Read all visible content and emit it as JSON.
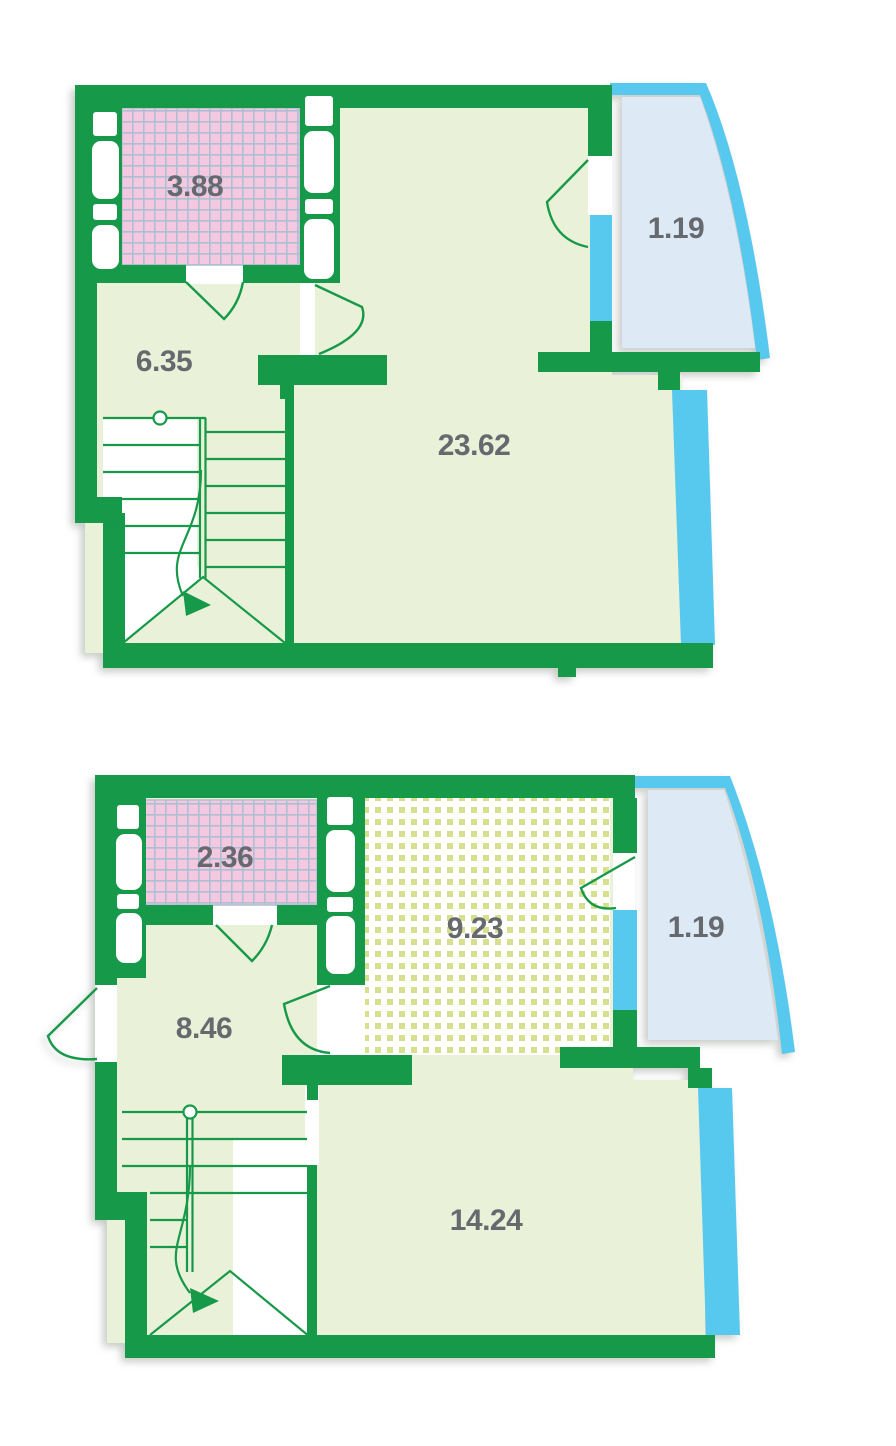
{
  "document": {
    "type": "apartment-floor-plan",
    "levels": 2
  },
  "colors": {
    "wall_green": "#17994a",
    "floor_light_green": "#e9f1d9",
    "bathroom_tile_pink": "#f4c8e1",
    "tile_grid_line": "#aebfd2",
    "kitchen_dot_yellow_green": "#d6e08d",
    "kitchen_background": "#ffffff",
    "balcony_fill_light_blue": "#dde9f5",
    "glazing_cyan": "#57c8ee",
    "label_grey": "#66696e"
  },
  "plans": [
    {
      "name": "upper-level",
      "rooms": [
        {
          "id": "bathroom",
          "area": "3.88"
        },
        {
          "id": "hallway",
          "area": "6.35"
        },
        {
          "id": "living-room",
          "area": "23.62"
        },
        {
          "id": "balcony",
          "area": "1.19"
        }
      ]
    },
    {
      "name": "lower-level",
      "rooms": [
        {
          "id": "bathroom",
          "area": "2.36"
        },
        {
          "id": "hallway",
          "area": "8.46"
        },
        {
          "id": "kitchen",
          "area": "9.23"
        },
        {
          "id": "living-room",
          "area": "14.24"
        },
        {
          "id": "balcony",
          "area": "1.19"
        }
      ]
    }
  ]
}
